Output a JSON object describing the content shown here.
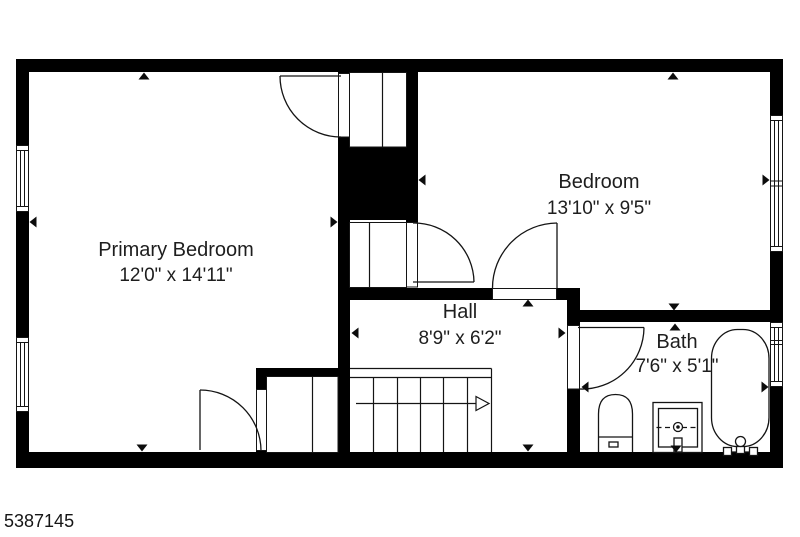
{
  "listing": {
    "id": "5387145"
  },
  "rooms": {
    "primary_bedroom": {
      "name": "Primary Bedroom",
      "dims": "12'0\" x 14'11\""
    },
    "bedroom": {
      "name": "Bedroom",
      "dims": "13'10\" x 9'5\""
    },
    "hall": {
      "name": "Hall",
      "dims": "8'9\" x 6'2\""
    },
    "bath": {
      "name": "Bath",
      "dims": "7'6\" x 5'1\""
    }
  },
  "fixtures": [
    "toilet",
    "sink-vanity",
    "bathtub",
    "staircase-up-arrow",
    "closets",
    "windows",
    "doors"
  ],
  "colors": {
    "walls": "#000000",
    "background": "#ffffff",
    "text": "#1e1e1e"
  }
}
